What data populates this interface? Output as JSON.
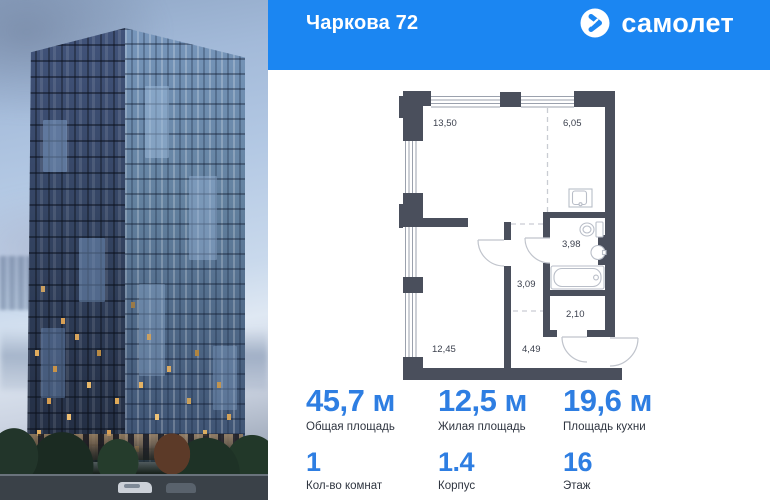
{
  "header": {
    "title": "Чаркова 72",
    "brand": "самолет"
  },
  "plan": {
    "rooms": [
      {
        "id": "kitchen-living",
        "area": "13,50"
      },
      {
        "id": "hall-top",
        "area": "6,05"
      },
      {
        "id": "bathroom",
        "area": "3,98"
      },
      {
        "id": "hallway",
        "area": "3,09"
      },
      {
        "id": "closet",
        "area": "2,10"
      },
      {
        "id": "bedroom",
        "area": "12,45"
      },
      {
        "id": "hallway-lower",
        "area": "4,49"
      }
    ]
  },
  "stats": {
    "areas": [
      {
        "value": "45,7 м",
        "label": "Общая площадь"
      },
      {
        "value": "12,5 м",
        "label": "Жилая площадь"
      },
      {
        "value": "19,6 м",
        "label": "Площадь кухни"
      }
    ],
    "details": [
      {
        "value": "1",
        "label": "Кол-во комнат"
      },
      {
        "value": "1.4",
        "label": "Корпус"
      },
      {
        "value": "16",
        "label": "Этаж"
      }
    ]
  },
  "colors": {
    "header_bg": "#1b86f2",
    "stat_value": "#2e7ee2",
    "plan_wall": "#4a4f5c"
  }
}
